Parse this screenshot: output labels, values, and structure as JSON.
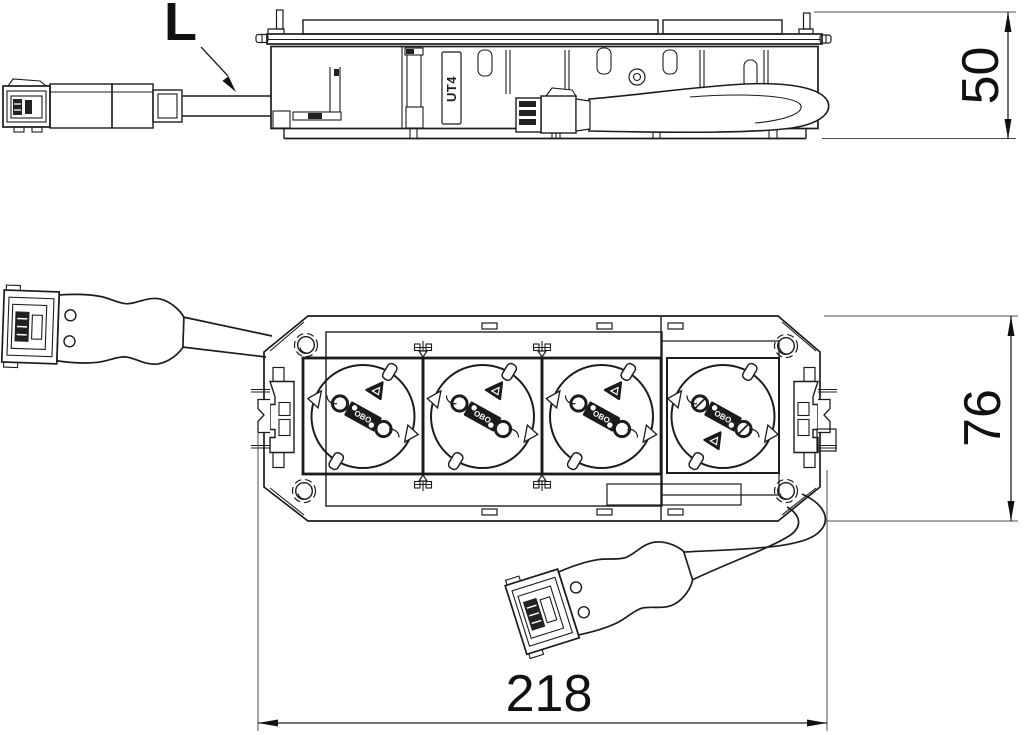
{
  "drawing": {
    "callout_label": "L",
    "insert_label": "UT4",
    "socket_brand": "OBO",
    "dimensions": {
      "side_height_mm": "50",
      "depth_mm": "76",
      "length_mm": "218"
    },
    "colors": {
      "line": "#1c1c1c",
      "background": "#ffffff"
    }
  }
}
